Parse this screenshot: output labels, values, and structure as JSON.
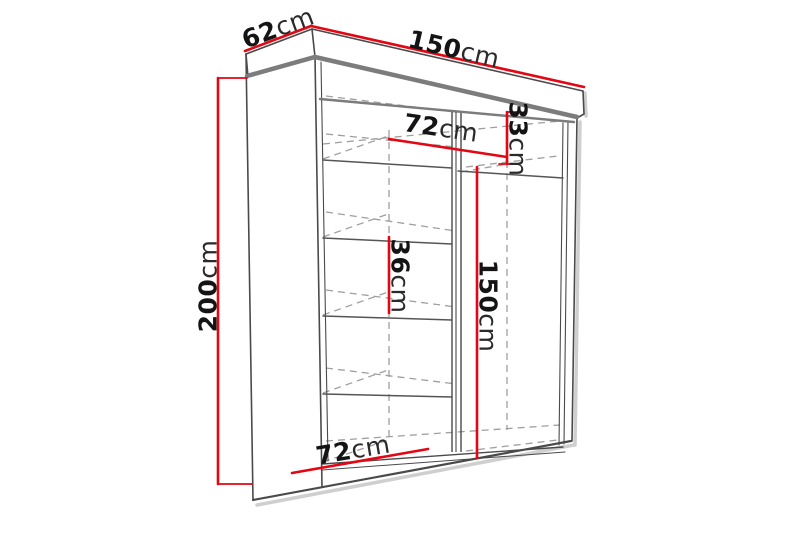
{
  "title": "Wardrobe dimension diagram",
  "colors": {
    "dimension_red": "#e30613",
    "outline": "#4a4a4a",
    "edge_thick": "#7c7c7c",
    "dashed_guide": "#9f9f9f",
    "shadow": "#cfcfcf",
    "label_text": "#141414",
    "background": "#ffffff"
  },
  "dimensions": {
    "depth": {
      "value": "62",
      "unit": "cm"
    },
    "width": {
      "value": "150",
      "unit": "cm"
    },
    "height": {
      "value": "200",
      "unit": "cm"
    },
    "left_section_top_width": {
      "value": "72",
      "unit": "cm"
    },
    "top_compartment_height": {
      "value": "33",
      "unit": "cm"
    },
    "shelf_spacing": {
      "value": "36",
      "unit": "cm"
    },
    "hanging_section_height": {
      "value": "150",
      "unit": "cm"
    },
    "left_section_bottom_width": {
      "value": "72",
      "unit": "cm"
    }
  }
}
